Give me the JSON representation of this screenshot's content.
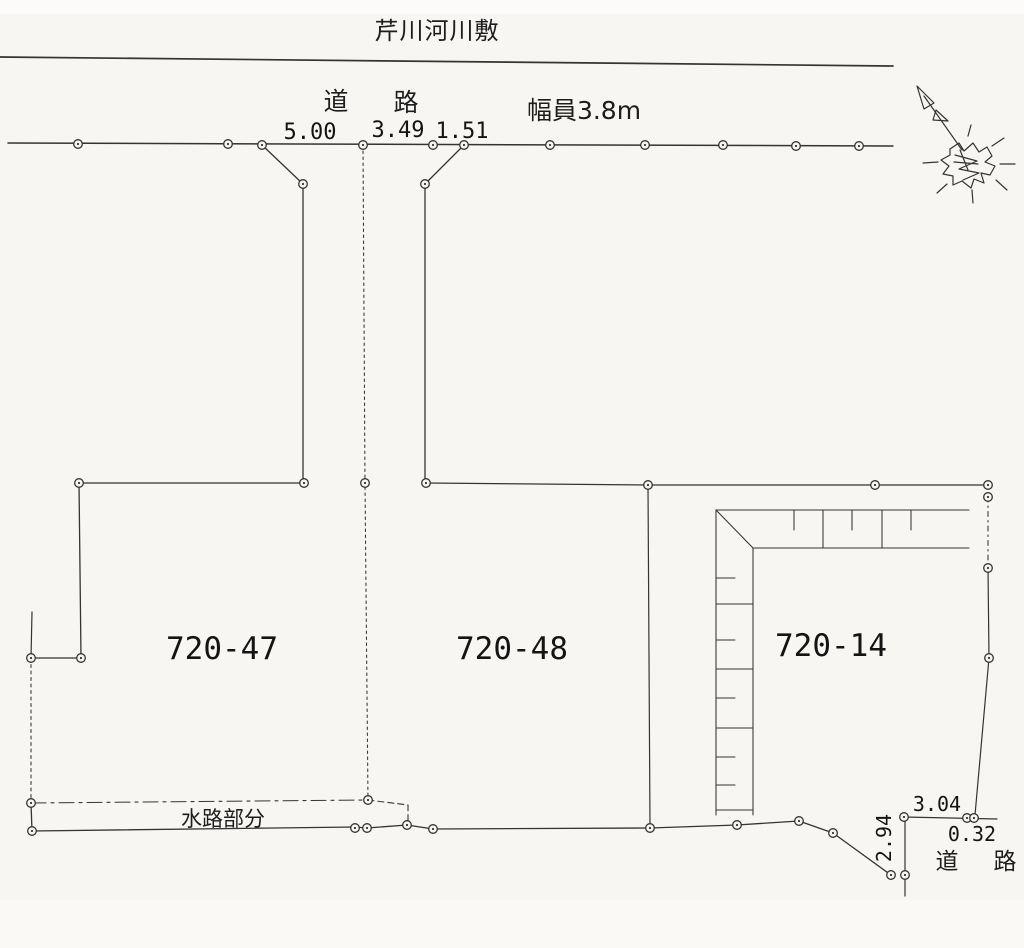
{
  "map": {
    "river_label": "芹川河川敷",
    "top_road": {
      "name_char_left": "道",
      "name_char_right": "路",
      "width_label": "幅員3.8m",
      "dims": [
        "5.00",
        "3.49",
        "1.51"
      ]
    },
    "parcels": [
      {
        "number": "720-47"
      },
      {
        "number": "720-48"
      },
      {
        "number": "720-14"
      }
    ],
    "waterway": {
      "label": "水路部分"
    },
    "bottom_road": {
      "name_char_left": "道",
      "name_char_right": "路",
      "dim_top": "3.04",
      "dim_right": "0.32",
      "dim_left": "2.94"
    }
  },
  "colors": {
    "line": "#343434",
    "text": "#1d1d1d",
    "background": "#f7f6f2"
  }
}
